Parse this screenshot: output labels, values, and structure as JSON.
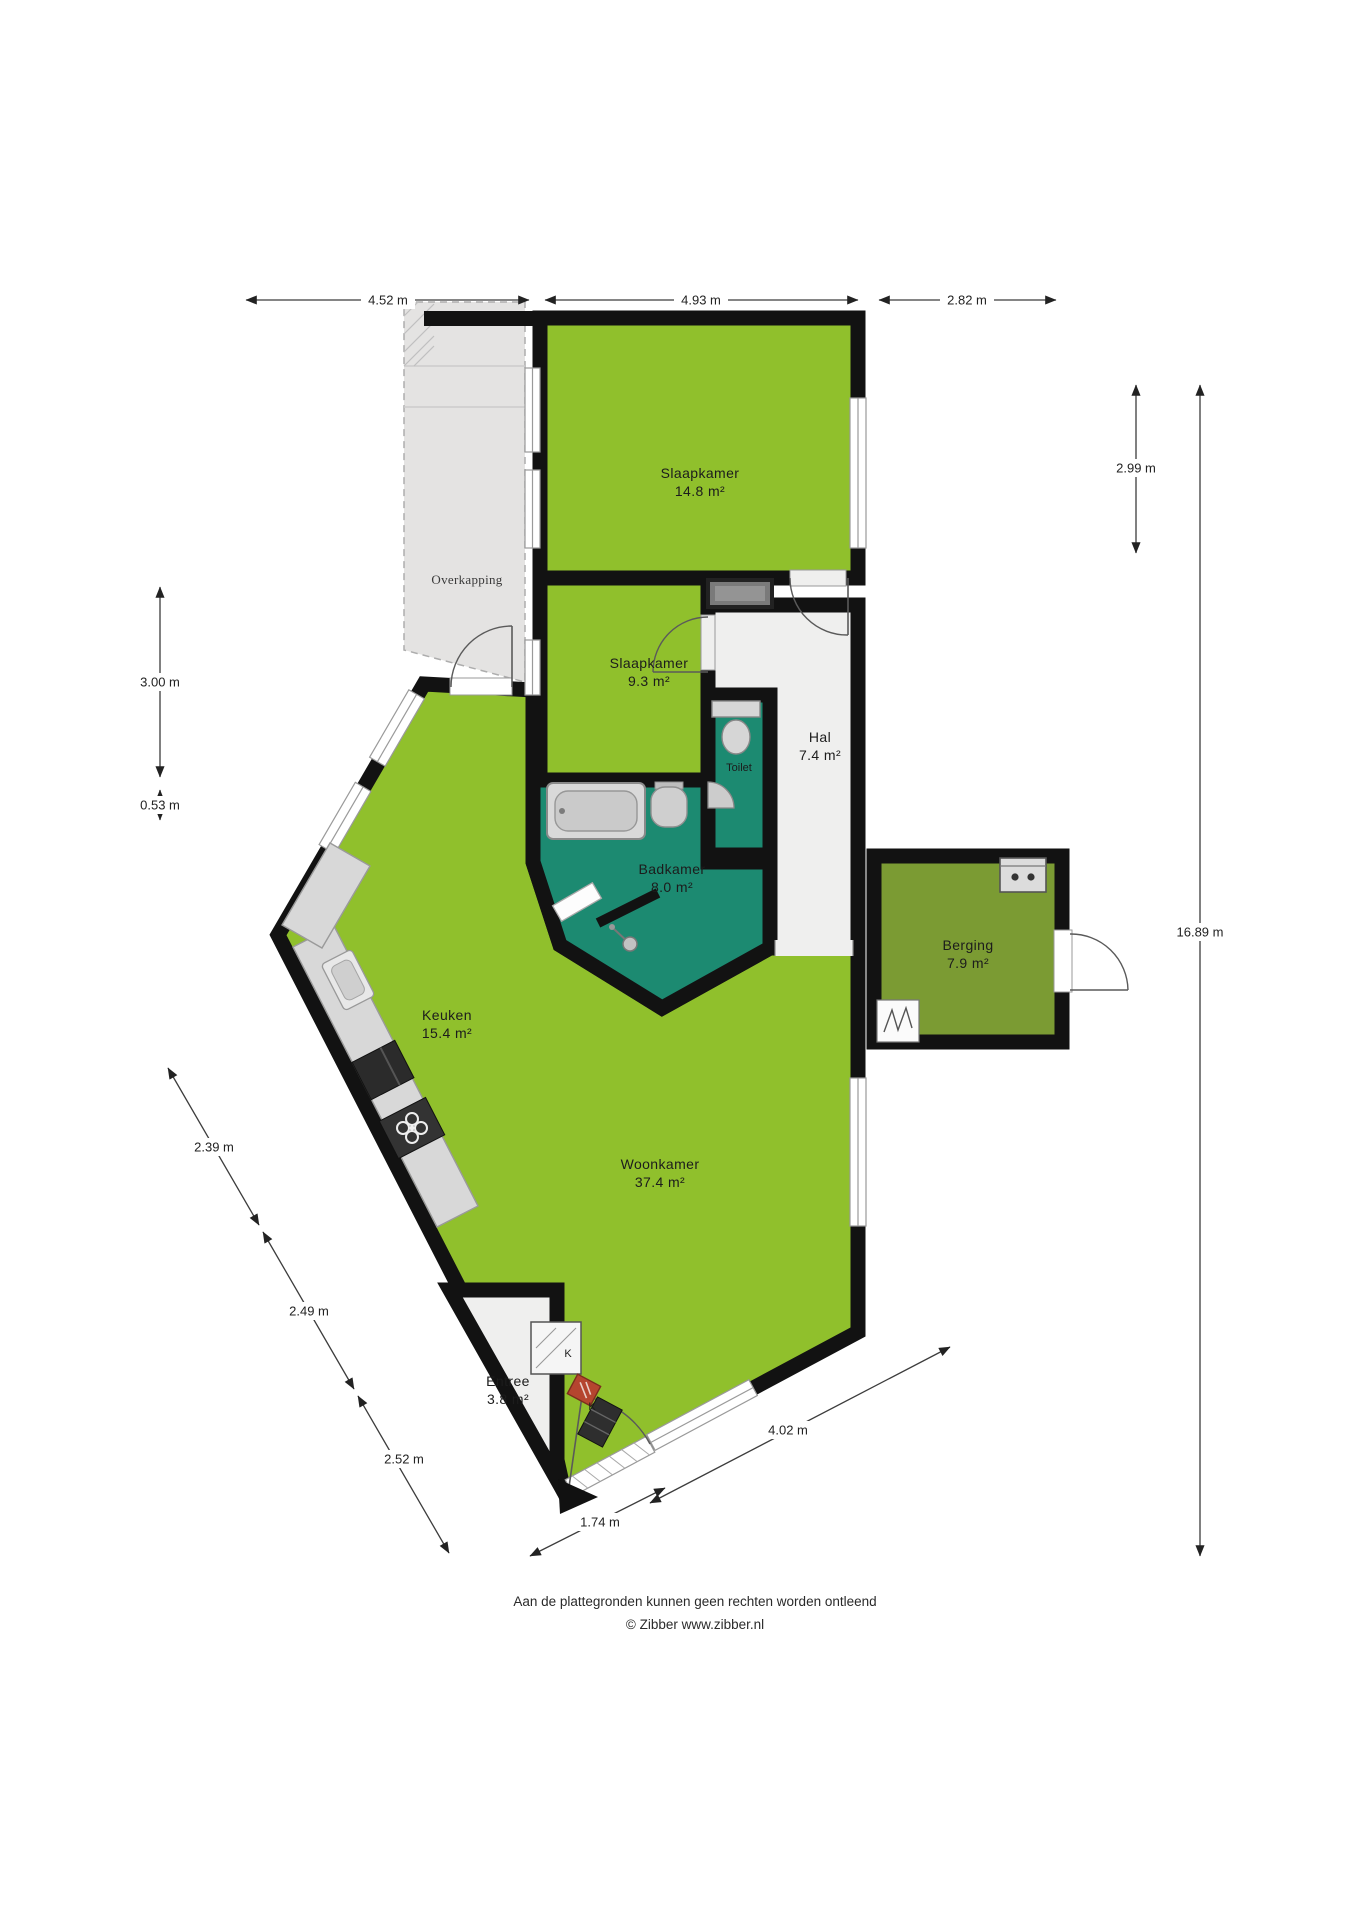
{
  "plan": {
    "rooms": [
      {
        "name": "Slaapkamer",
        "area": "14.8 m²"
      },
      {
        "name": "Slaapkamer",
        "area": "9.3 m²"
      },
      {
        "name": "Hal",
        "area": "7.4 m²"
      },
      {
        "name": "Toilet",
        "area": ""
      },
      {
        "name": "Badkamer",
        "area": "8.0 m²"
      },
      {
        "name": "Berging",
        "area": "7.9 m²"
      },
      {
        "name": "Keuken",
        "area": "15.4 m²"
      },
      {
        "name": "Woonkamer",
        "area": "37.4 m²"
      },
      {
        "name": "Entree",
        "area": "3.8 m²"
      }
    ],
    "outdoor_label": "Overkapping",
    "closet_labels": {
      "k1": "K",
      "k2": "K"
    },
    "dimensions": {
      "top": [
        "4.52 m",
        "4.93 m",
        "2.82 m"
      ],
      "right": [
        "2.99 m",
        "16.89 m"
      ],
      "left": [
        "3.00 m",
        "0.53 m"
      ],
      "bottom_left": [
        "2.39 m",
        "2.49 m",
        "2.52 m"
      ],
      "bottom_right": [
        "4.02 m",
        "1.74 m"
      ]
    },
    "footer": {
      "disclaimer": "Aan de plattegronden kunnen geen rechten worden ontleend",
      "credit": "© Zibber www.zibber.nl"
    },
    "colors": {
      "room_green": "#90c02c",
      "berging_green": "#7b9b33",
      "bath_teal": "#1c8a71",
      "hall_floor": "#efefee",
      "wall": "#121212"
    }
  }
}
